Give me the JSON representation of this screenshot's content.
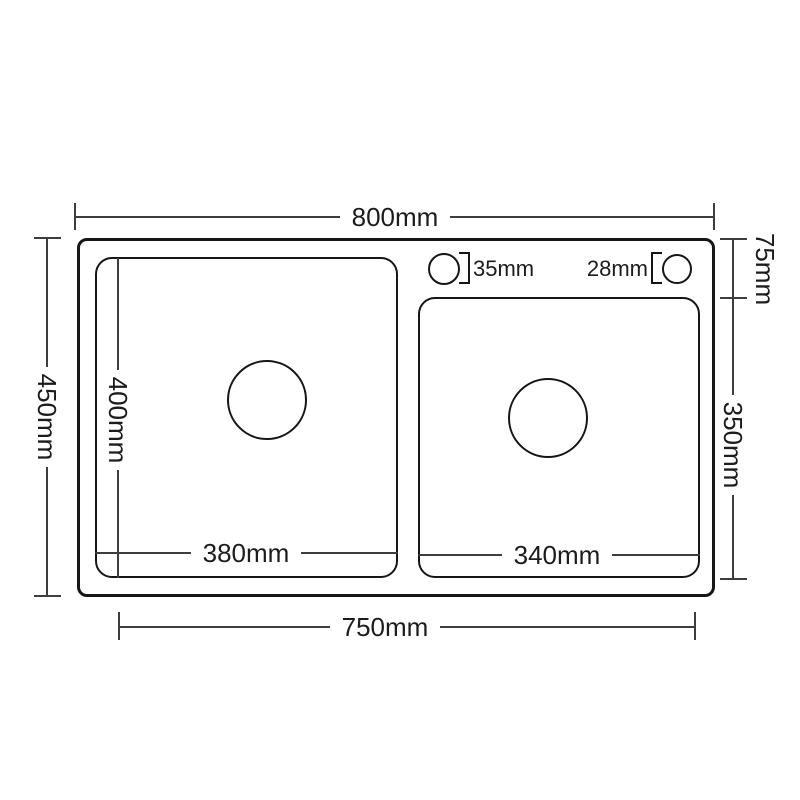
{
  "diagram": {
    "type": "technical-drawing",
    "subject": "double-bowl kitchen sink top view with dimensions",
    "background_color": "#ffffff",
    "shape_line_color": "#161616",
    "dimension_line_color": "#3d3d3d",
    "dimensions": {
      "overall_width": "800mm",
      "overall_depth": "450mm",
      "bowl_outer_span": "750mm",
      "left_bowl_inner_width": "380mm",
      "left_bowl_inner_depth": "400mm",
      "right_bowl_inner_width": "340mm",
      "right_bowl_inner_depth": "350mm",
      "rim_to_right_bowl_offset": "75mm",
      "faucet_hole_left_diameter": "35mm",
      "faucet_hole_right_diameter": "28mm"
    }
  }
}
